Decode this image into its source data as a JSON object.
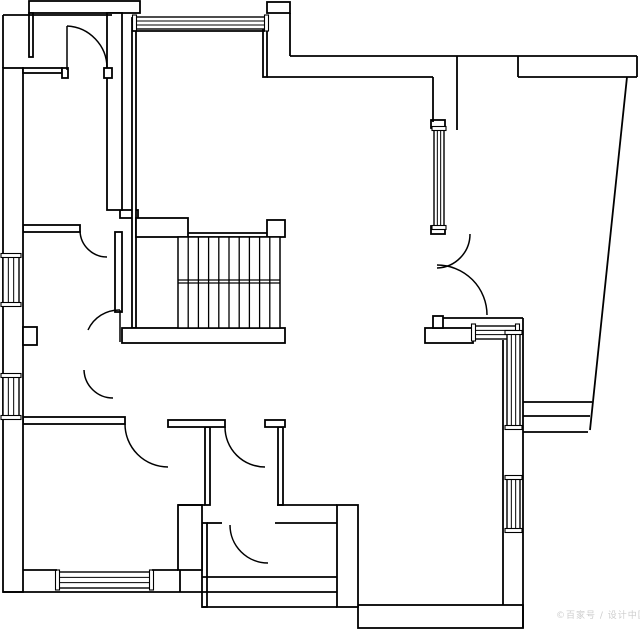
{
  "canvas": {
    "width": 640,
    "height": 631,
    "background": "#ffffff",
    "line_color": "#000000",
    "watermark_color": "#cdcdcd"
  },
  "watermark": {
    "text": "©百家号 / 设计中国"
  },
  "floorplan": {
    "wall_rects": [
      [
        29,
        1,
        111,
        12
      ],
      [
        267,
        2,
        23,
        11
      ],
      [
        425,
        328,
        48,
        15
      ],
      [
        358,
        605,
        165,
        23
      ],
      [
        337,
        505,
        21,
        102
      ],
      [
        202,
        523,
        5,
        84
      ],
      [
        205,
        427,
        5,
        78
      ],
      [
        278,
        427,
        5,
        78
      ],
      [
        178,
        505,
        24,
        65
      ],
      [
        23,
        417,
        102,
        7
      ],
      [
        168,
        420,
        57,
        7
      ],
      [
        265,
        420,
        20,
        7
      ],
      [
        120,
        210,
        18,
        8
      ],
      [
        132,
        18,
        4,
        310
      ],
      [
        267,
        220,
        18,
        17
      ],
      [
        136,
        218,
        52,
        19
      ],
      [
        122,
        328,
        163,
        15
      ],
      [
        107,
        13,
        15,
        197
      ],
      [
        23,
        225,
        57,
        7
      ],
      [
        115,
        232,
        7,
        80
      ],
      [
        3,
        68,
        20,
        524
      ],
      [
        23,
        327,
        14,
        18
      ],
      [
        23,
        68,
        39,
        5
      ],
      [
        62,
        68,
        6,
        10
      ],
      [
        104,
        68,
        8,
        10
      ],
      [
        263,
        18,
        4,
        59
      ],
      [
        29,
        13,
        4,
        44
      ],
      [
        431,
        120,
        14,
        8
      ],
      [
        431,
        226,
        14,
        8
      ],
      [
        433,
        316,
        10,
        12
      ]
    ],
    "wall_lines": [
      [
        3,
        15,
        112,
        15
      ],
      [
        3,
        15,
        3,
        68
      ],
      [
        290,
        13,
        290,
        56
      ],
      [
        290,
        56,
        637,
        56
      ],
      [
        267,
        77,
        433,
        77
      ],
      [
        518,
        77,
        637,
        77
      ],
      [
        518,
        56,
        518,
        77
      ],
      [
        637,
        56,
        637,
        77
      ],
      [
        457,
        56,
        457,
        130
      ],
      [
        433,
        77,
        433,
        122
      ],
      [
        443,
        318,
        523,
        318
      ],
      [
        523,
        318,
        523,
        628
      ],
      [
        503,
        340,
        503,
        605
      ],
      [
        523,
        402,
        592,
        402
      ],
      [
        523,
        416,
        590,
        416
      ],
      [
        523,
        432,
        588,
        432
      ],
      [
        627,
        77,
        590,
        430
      ],
      [
        207,
        523,
        222,
        523
      ],
      [
        275,
        523,
        337,
        523
      ],
      [
        202,
        577,
        337,
        577
      ],
      [
        3,
        592,
        337,
        592
      ],
      [
        202,
        607,
        337,
        607
      ],
      [
        277,
        505,
        337,
        505
      ],
      [
        178,
        505,
        205,
        505
      ],
      [
        23,
        570,
        57,
        570
      ],
      [
        152,
        570,
        178,
        570
      ],
      [
        188,
        233,
        267,
        233
      ],
      [
        188,
        237,
        267,
        237
      ],
      [
        178,
        280,
        280,
        280
      ],
      [
        178,
        283,
        280,
        283
      ],
      [
        132,
        31,
        265,
        31
      ],
      [
        180,
        570,
        180,
        592
      ]
    ],
    "windows": [
      {
        "x": 434,
        "y": 128,
        "w": 10,
        "h": 100,
        "dir": "v"
      },
      {
        "x": 473,
        "y": 326,
        "w": 45,
        "h": 13,
        "dir": "h"
      },
      {
        "x": 507,
        "y": 332,
        "w": 13,
        "h": 96,
        "dir": "v"
      },
      {
        "x": 507,
        "y": 477,
        "w": 13,
        "h": 54,
        "dir": "v"
      },
      {
        "x": 57,
        "y": 572,
        "w": 95,
        "h": 16,
        "dir": "h"
      },
      {
        "x": 3,
        "y": 255,
        "w": 16,
        "h": 50,
        "dir": "v"
      },
      {
        "x": 3,
        "y": 375,
        "w": 16,
        "h": 43,
        "dir": "v"
      },
      {
        "x": 134,
        "y": 17,
        "w": 133,
        "h": 12,
        "dir": "h"
      }
    ],
    "doors": [
      {
        "name": "entry-door-top-left",
        "path": "M67,26 L67,70 M67,26 A42,42 0 0 1 107,68"
      },
      {
        "name": "bedroom-inner-door",
        "path": "M80,231 A27,27 0 0 0 107,257"
      },
      {
        "name": "wc-door-upper",
        "path": "M120,310 L120,342 M88,330 A34,34 0 0 1 120,310"
      },
      {
        "name": "wc-door-lower",
        "path": "M84,370 A29,29 0 0 0 113,398"
      },
      {
        "name": "bottom-left-room-door",
        "path": "M125,424 A43,43 0 0 0 168,467"
      },
      {
        "name": "bathroom-door",
        "path": "M225,427 A40,40 0 0 0 265,467"
      },
      {
        "name": "bottom-middle-room-door",
        "path": "M230,525 A38,38 0 0 0 268,563"
      },
      {
        "name": "main-double-door-leaf-small",
        "path": "M470,234 A34,34 0 0 1 437,268"
      },
      {
        "name": "main-double-door-leaf-large",
        "path": "M437,265 A50,50 0 0 1 487,315"
      }
    ],
    "stairs": {
      "x": 178,
      "y": 237,
      "w": 102,
      "h": 91,
      "treads": 10,
      "mid_lines": [
        280,
        283
      ]
    }
  }
}
